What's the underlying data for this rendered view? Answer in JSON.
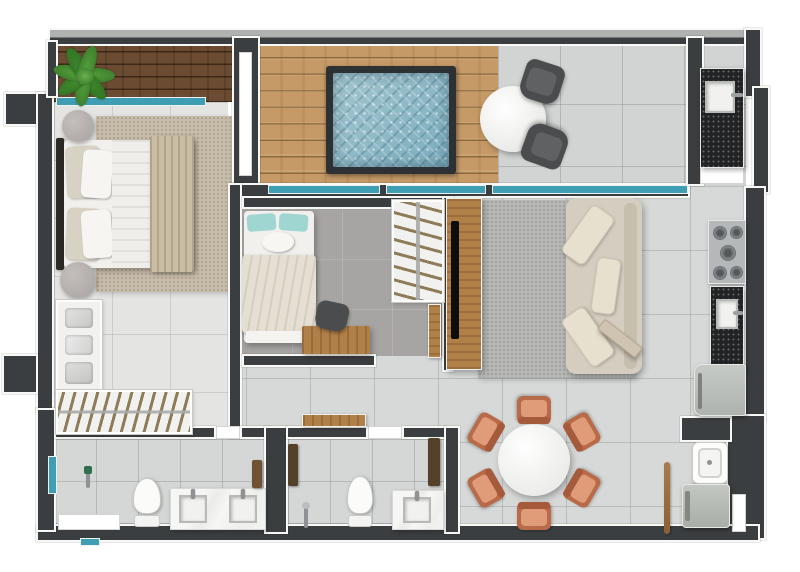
{
  "scene": {
    "title": "Top-down 3D rendered apartment floor plan",
    "rooms": [
      {
        "name": "master balcony",
        "features": [
          "dark wood deck",
          "potted fern plant",
          "sliding glass window"
        ]
      },
      {
        "name": "pool deck",
        "features": [
          "light wood decking",
          "plunge pool with blue water",
          "access door"
        ]
      },
      {
        "name": "terrace",
        "features": [
          "round marble bistro table",
          "two dark chairs",
          "glass sliding doors"
        ]
      },
      {
        "name": "kitchen",
        "features": [
          "black granite sink counter",
          "five-burner cooktop",
          "black counter with sink",
          "refrigerator",
          "white cabinet door"
        ]
      },
      {
        "name": "master bedroom",
        "features": [
          "double bed with beige blanket",
          "two round nightstands",
          "beige rug",
          "wardrobe shelves with folded clothes",
          "hanging rail with hangers"
        ]
      },
      {
        "name": "bedroom 2",
        "features": [
          "single bed with teal pillows",
          "wooden desk",
          "desk chair",
          "open closet with hangers",
          "wooden door"
        ]
      },
      {
        "name": "living room",
        "features": [
          "beige three-seat sofa",
          "gray rug",
          "wood tv panel",
          "wall-mounted tv",
          "entrance door ajar"
        ]
      },
      {
        "name": "dining area",
        "features": [
          "round marble dining table",
          "six terracotta chairs"
        ]
      },
      {
        "name": "bathroom 1",
        "features": [
          "toilet",
          "double-sink marble vanity",
          "shower column",
          "glass screen",
          "towel rack",
          "white shower tray"
        ]
      },
      {
        "name": "bathroom 2",
        "features": [
          "toilet",
          "single-sink marble vanity",
          "shower column",
          "towel racks",
          "wooden console shelf"
        ]
      },
      {
        "name": "laundry",
        "features": [
          "wash tub",
          "washing machine",
          "broom",
          "service door"
        ]
      }
    ]
  },
  "colors": {
    "wall": "#3b3e40",
    "slab": "#b0b2b1",
    "glass": "#3f9db4",
    "floor": "#d7d9d8",
    "terrace": "#d2d4d3",
    "masterFloor": "#e4e5e3",
    "bathFloor": "#d5d7d6",
    "b2Floor": "#a6a5a3",
    "deckLight": "#c59a67",
    "deckDark": "#6b4c32",
    "wood": "#b08048",
    "pool": "#8abac7",
    "rugMaster": "#c7bcaa",
    "rugLiving": "#b7b8b6",
    "sofa": "#d5cec0",
    "cushion": "#e7e0cf",
    "bedWhite": "#f1f0ed",
    "blanket": "#c9bda4",
    "pillowTeal": "#9fd6d2",
    "counter": "#212325",
    "terracotta": "#b96a48",
    "terracottaLight": "#e09c78",
    "chairDark": "#4b4c4e",
    "appliance": "#b4b8b8",
    "plant": "#55a33b",
    "plantDark": "#39742a",
    "hanger": "#8d7c57",
    "doorLeaf": "#cfc3b1"
  }
}
